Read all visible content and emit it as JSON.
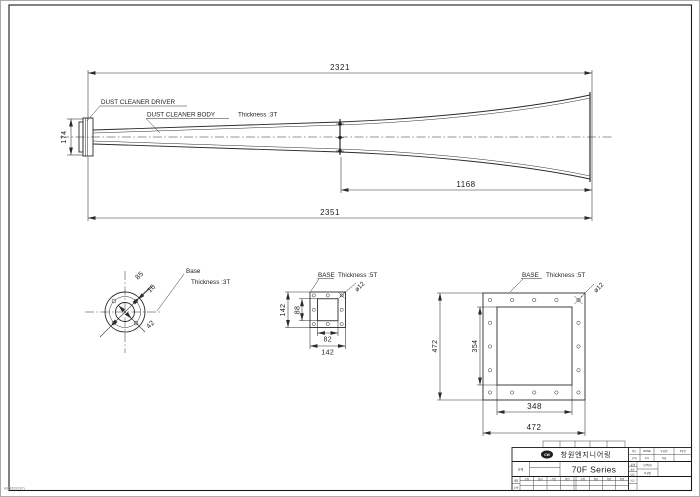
{
  "sheet": {
    "size_label": "A3(420X297)"
  },
  "main_view": {
    "label_driver": "DUST CLEANER DRIVER",
    "label_body": "DUST CLEANER BODY",
    "label_thickness": "Thickness :3T",
    "dim_top": "2321",
    "dim_height": "174",
    "dim_horn": "1168",
    "dim_total": "2351"
  },
  "detail_round": {
    "title": "Base",
    "thickness": "Thickness :3T",
    "dim_outer": "85",
    "dim_hole": "10",
    "dim_inner": "42"
  },
  "detail_flange_small": {
    "title": "BASE",
    "thickness": "Thickness :5T",
    "dim_hole": "ø12",
    "dim_outer_h": "142",
    "dim_inner_h": "88",
    "dim_inner_w": "82",
    "dim_outer_w": "142"
  },
  "detail_flange_large": {
    "title": "BASE",
    "thickness": "Thickness :5T",
    "dim_hole": "ø12",
    "dim_outer_h": "472",
    "dim_inner_h": "354",
    "dim_inner_w": "348",
    "dim_outer_w": "472"
  },
  "title_block": {
    "logo_text": "CW",
    "company": "창원엔지니어링",
    "series": "70F Series",
    "spec_label": "규격",
    "info": {
      "c1": "척도",
      "c2": "NONE",
      "c3": "투상법",
      "c4": "3각법",
      "c5": "단위",
      "c6": "mm",
      "c7": "작성",
      "c8": ""
    },
    "approvals": [
      "설계",
      "제도",
      "검도"
    ],
    "dwg_no_label": "도면번호",
    "date_label": "작성일",
    "mat_label": "재질",
    "qty_label": "수량",
    "note_label": "비고",
    "headers": [
      "공정",
      "일자",
      "작업",
      "확인",
      "공정",
      "일자",
      "작업",
      "확인"
    ]
  }
}
